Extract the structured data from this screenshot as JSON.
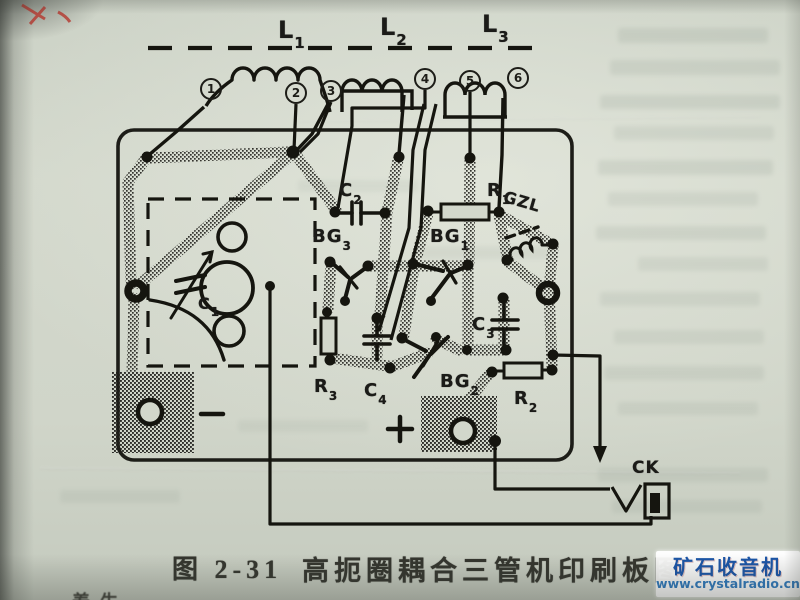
{
  "page": {
    "caption": {
      "number": "图 2-31",
      "title": "高扼圈耦合三管机印刷板图"
    },
    "bottom_partial_text": "养生",
    "watermark": {
      "title": "矿石收音机",
      "url": "www.crystalradio.cn"
    }
  },
  "diagram": {
    "coils": [
      {
        "base": "L",
        "sub": "1"
      },
      {
        "base": "L",
        "sub": "2"
      },
      {
        "base": "L",
        "sub": "3"
      }
    ],
    "terminals": [
      "1",
      "2",
      "3",
      "4",
      "5",
      "6"
    ],
    "components": {
      "c1": {
        "base": "C",
        "sub": "1"
      },
      "c2": {
        "base": "C",
        "sub": "2"
      },
      "c3": {
        "base": "C",
        "sub": "3"
      },
      "c4": {
        "base": "C",
        "sub": "4"
      },
      "r1": {
        "base": "R",
        "sub": "1"
      },
      "r2": {
        "base": "R",
        "sub": "2"
      },
      "r3": {
        "base": "R",
        "sub": "3"
      },
      "bg1": {
        "base": "BG",
        "sub": "1"
      },
      "bg2": {
        "base": "BG",
        "sub": "2"
      },
      "bg3": {
        "base": "BG",
        "sub": "3"
      },
      "gzl": {
        "label": "GZL"
      },
      "ck": {
        "label": "CK"
      },
      "plus_sign": "+",
      "minus_sign": "−"
    },
    "colors": {
      "ink": "#1d1d18",
      "paper": "#d2d7cb",
      "watermark_blue": "#1a55a8",
      "red_mark": "#b5372e"
    }
  }
}
